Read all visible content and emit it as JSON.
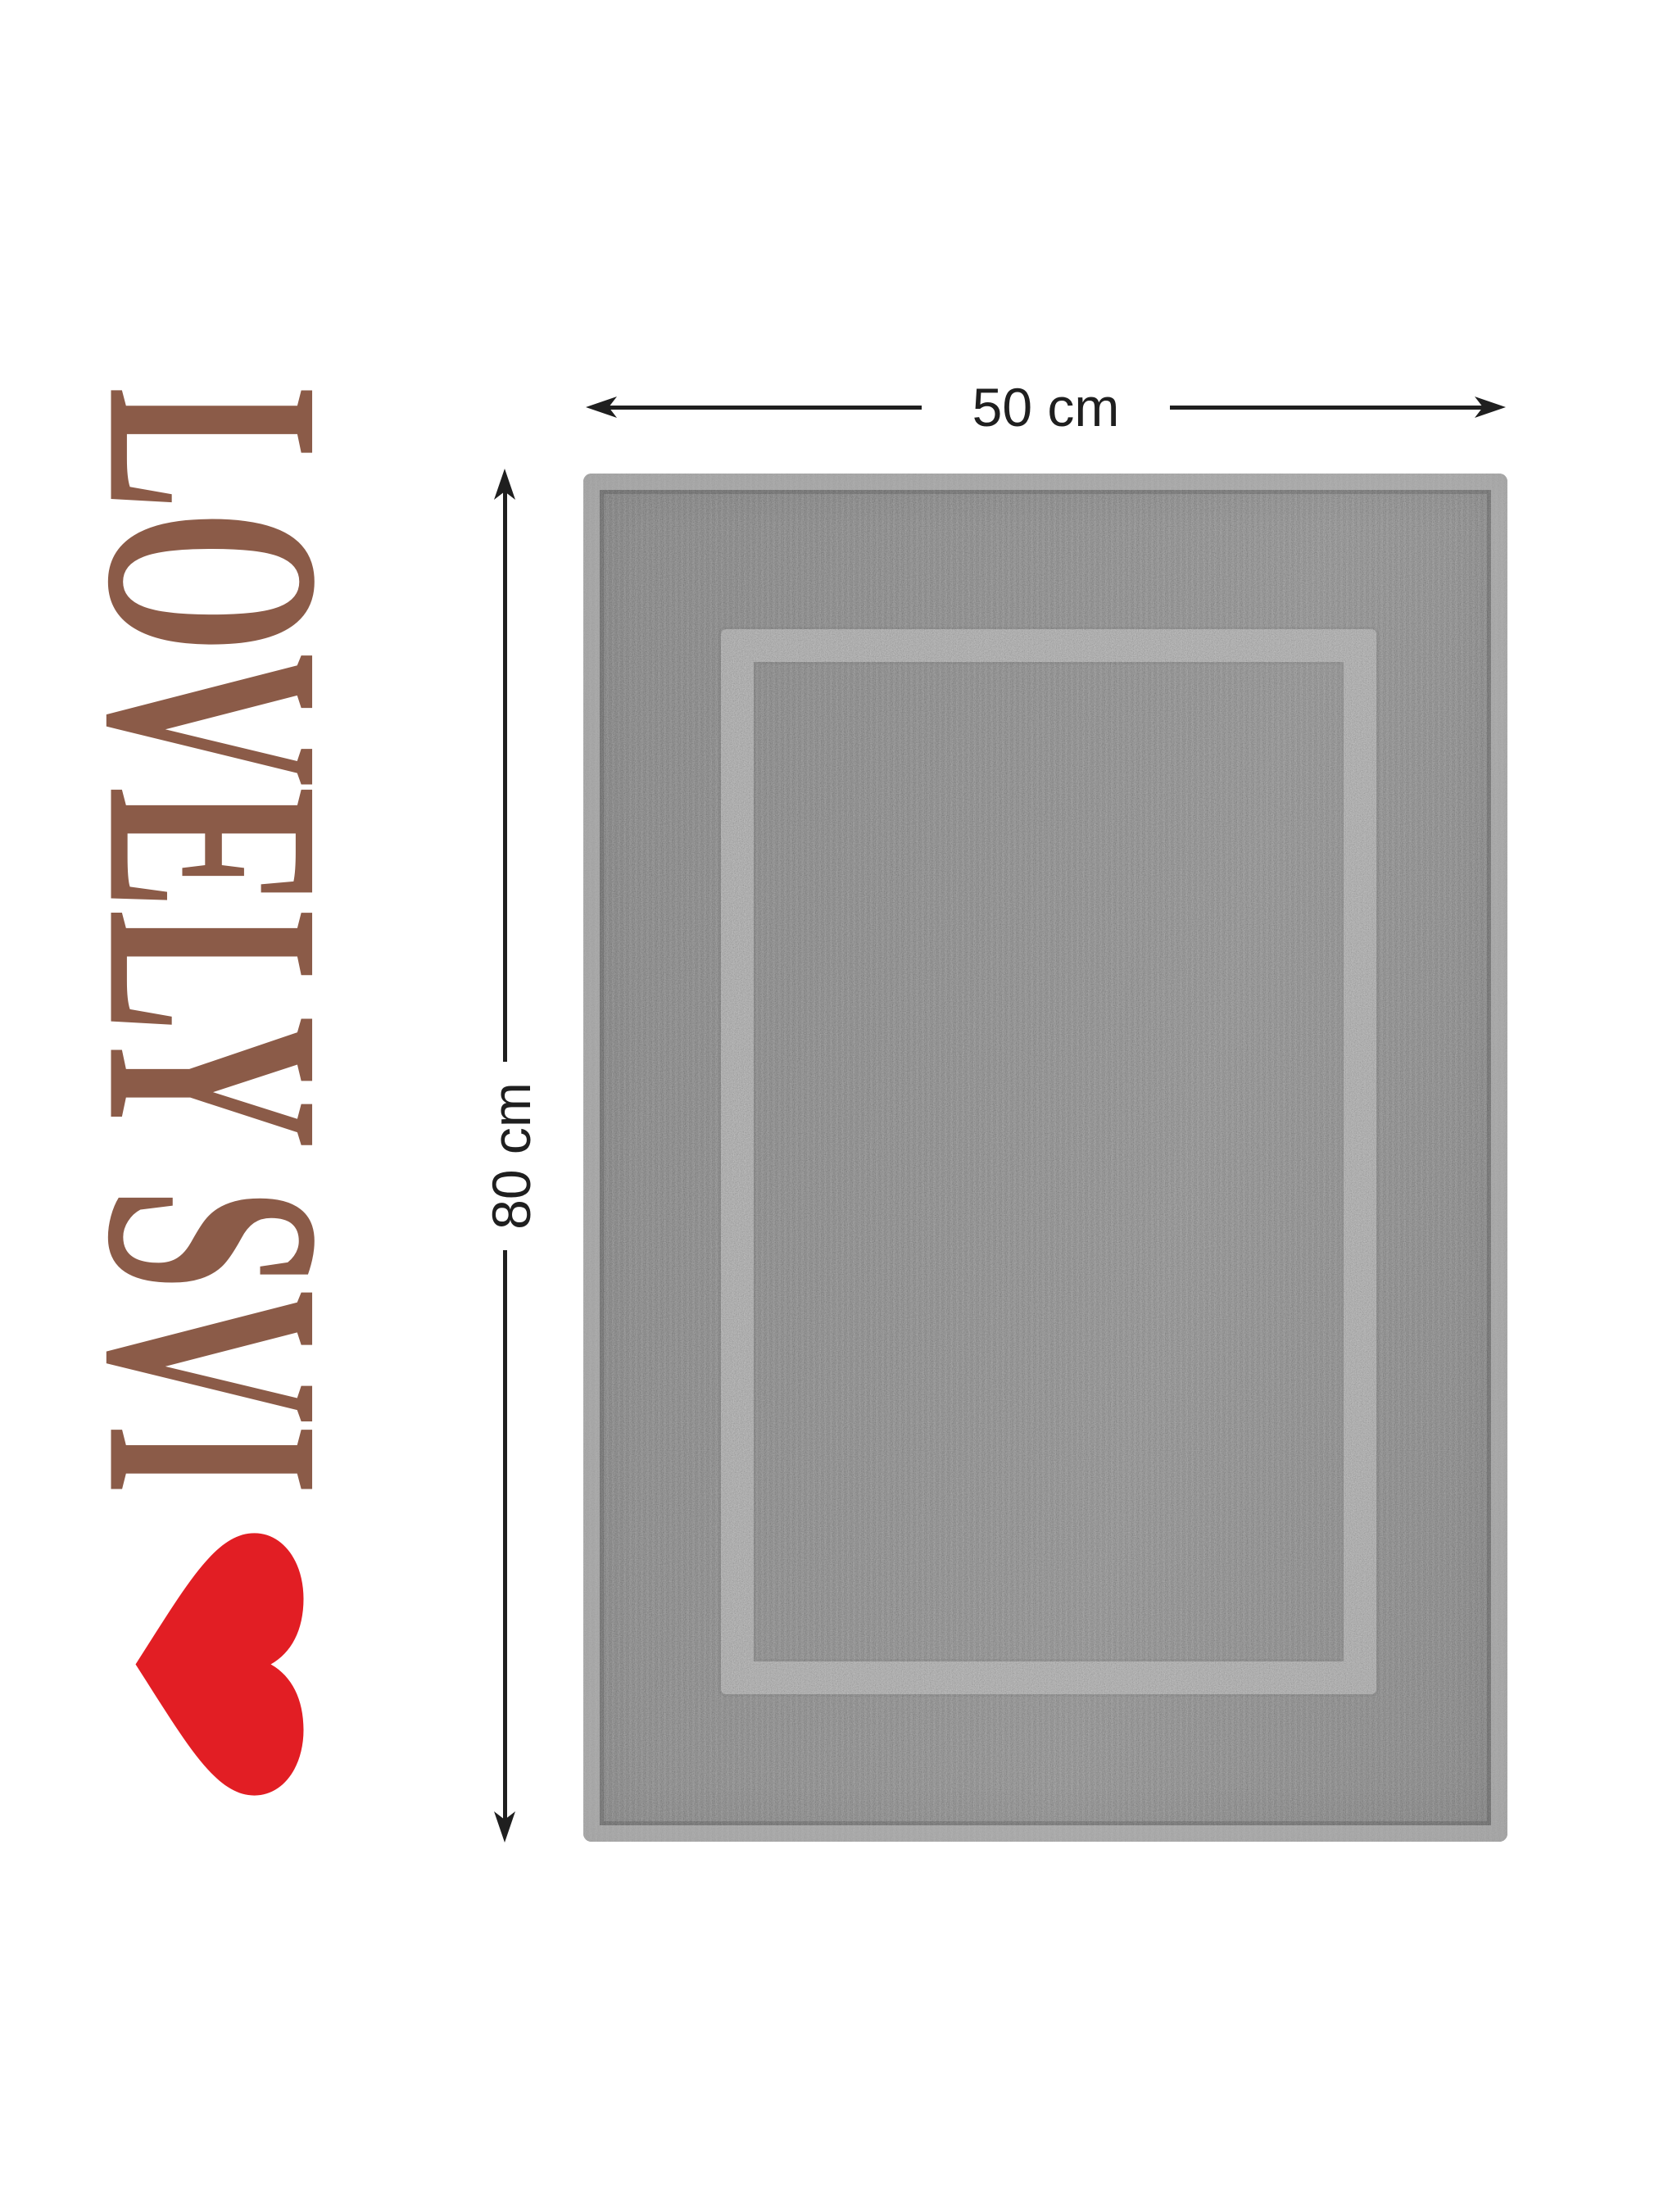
{
  "logo": {
    "brand": "LOVELY SVI",
    "heart_icon": "heart-icon"
  },
  "dimensions": {
    "width_label": "50 cm",
    "height_label": "80 cm"
  },
  "theme": {
    "background": "#ffffff",
    "brand_brown": "#8b5b48",
    "heart_red": "#e21e24",
    "line_dark": "#1f1f1f",
    "mat_base": "#767676",
    "mat_band": "#9d9d9d",
    "mat_hem": "#a6a6a6"
  }
}
